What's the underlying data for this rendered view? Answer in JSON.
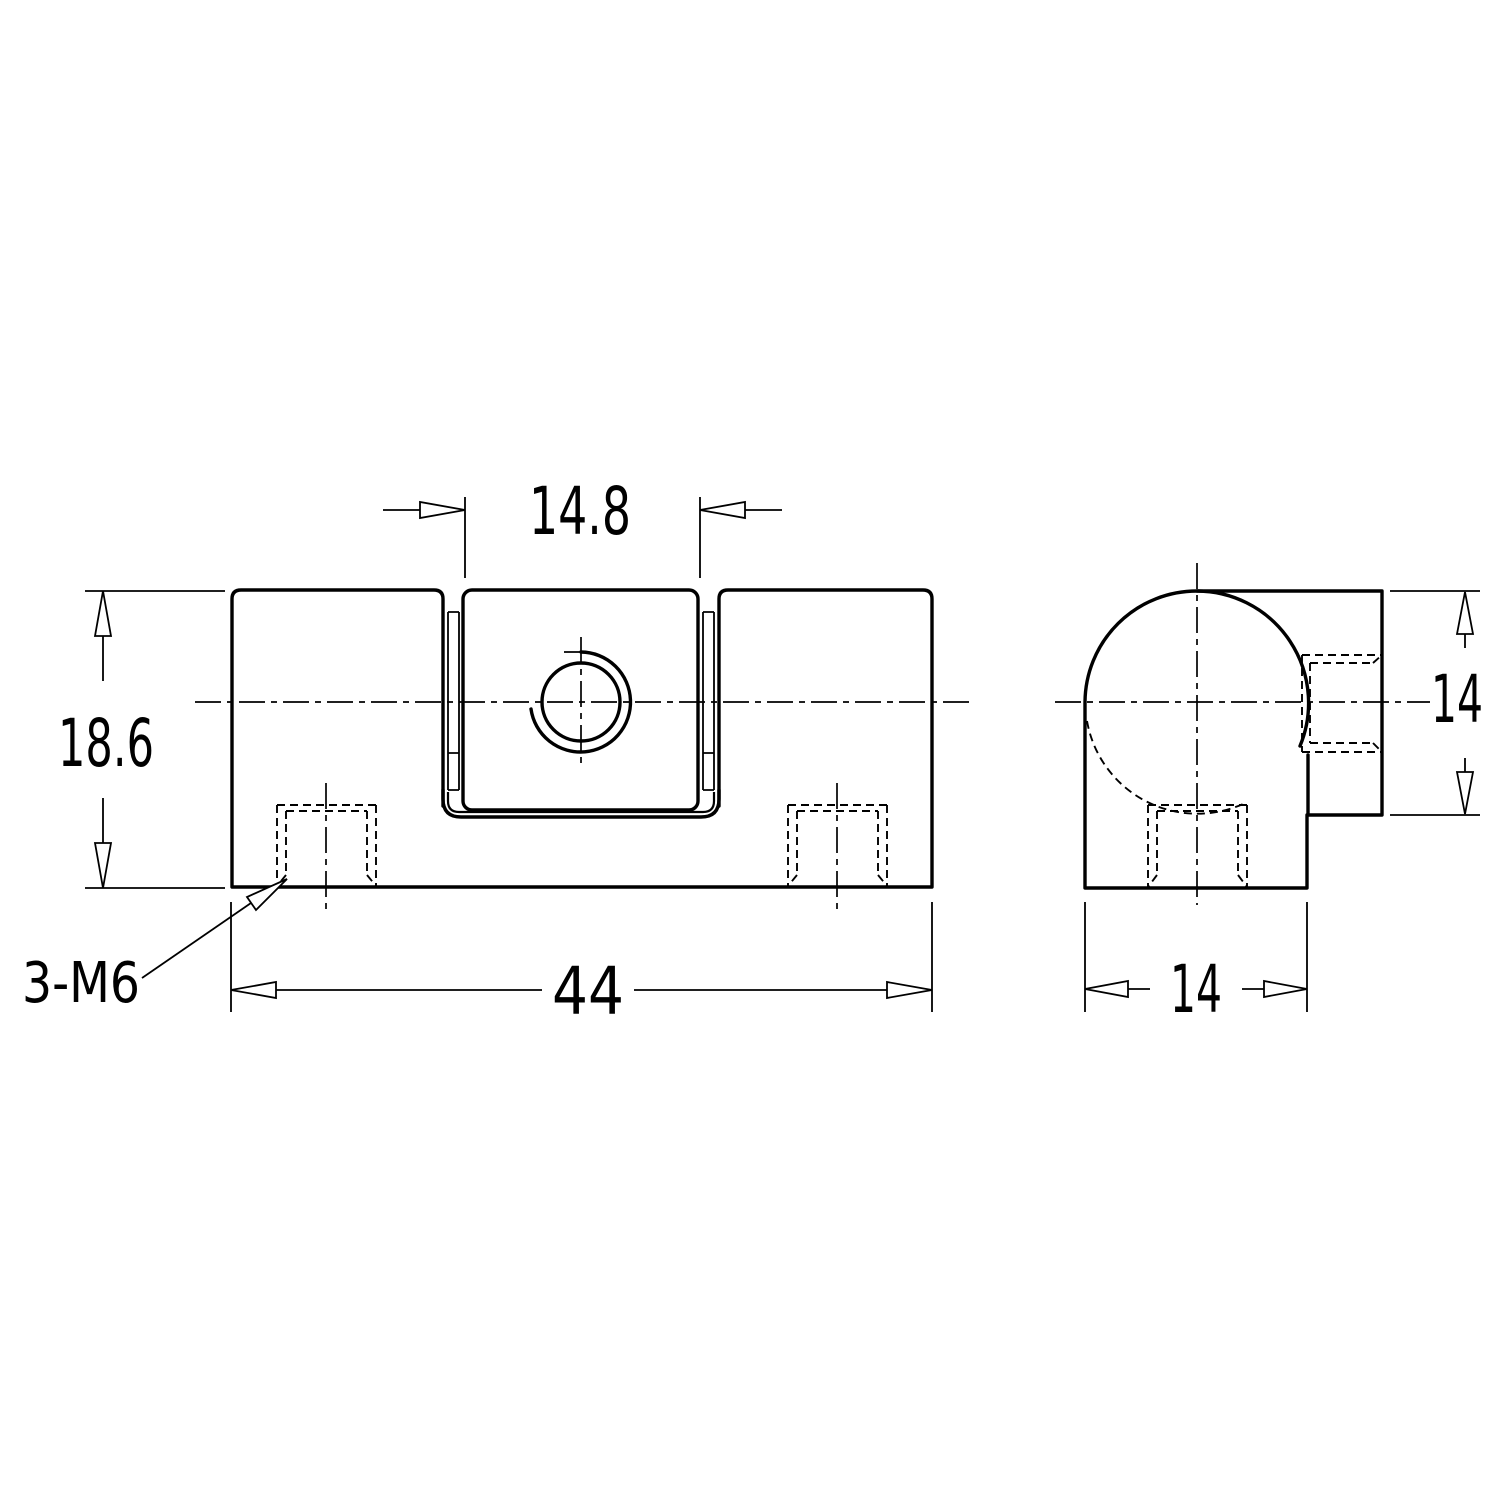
{
  "dimensions": {
    "nut_width": "14.8",
    "body_height": "18.6",
    "body_length": "44",
    "side_width": "14",
    "side_height": "14"
  },
  "callout": {
    "thread_note": "3-M6"
  },
  "colors": {
    "line": "#000000",
    "background": "#ffffff"
  }
}
